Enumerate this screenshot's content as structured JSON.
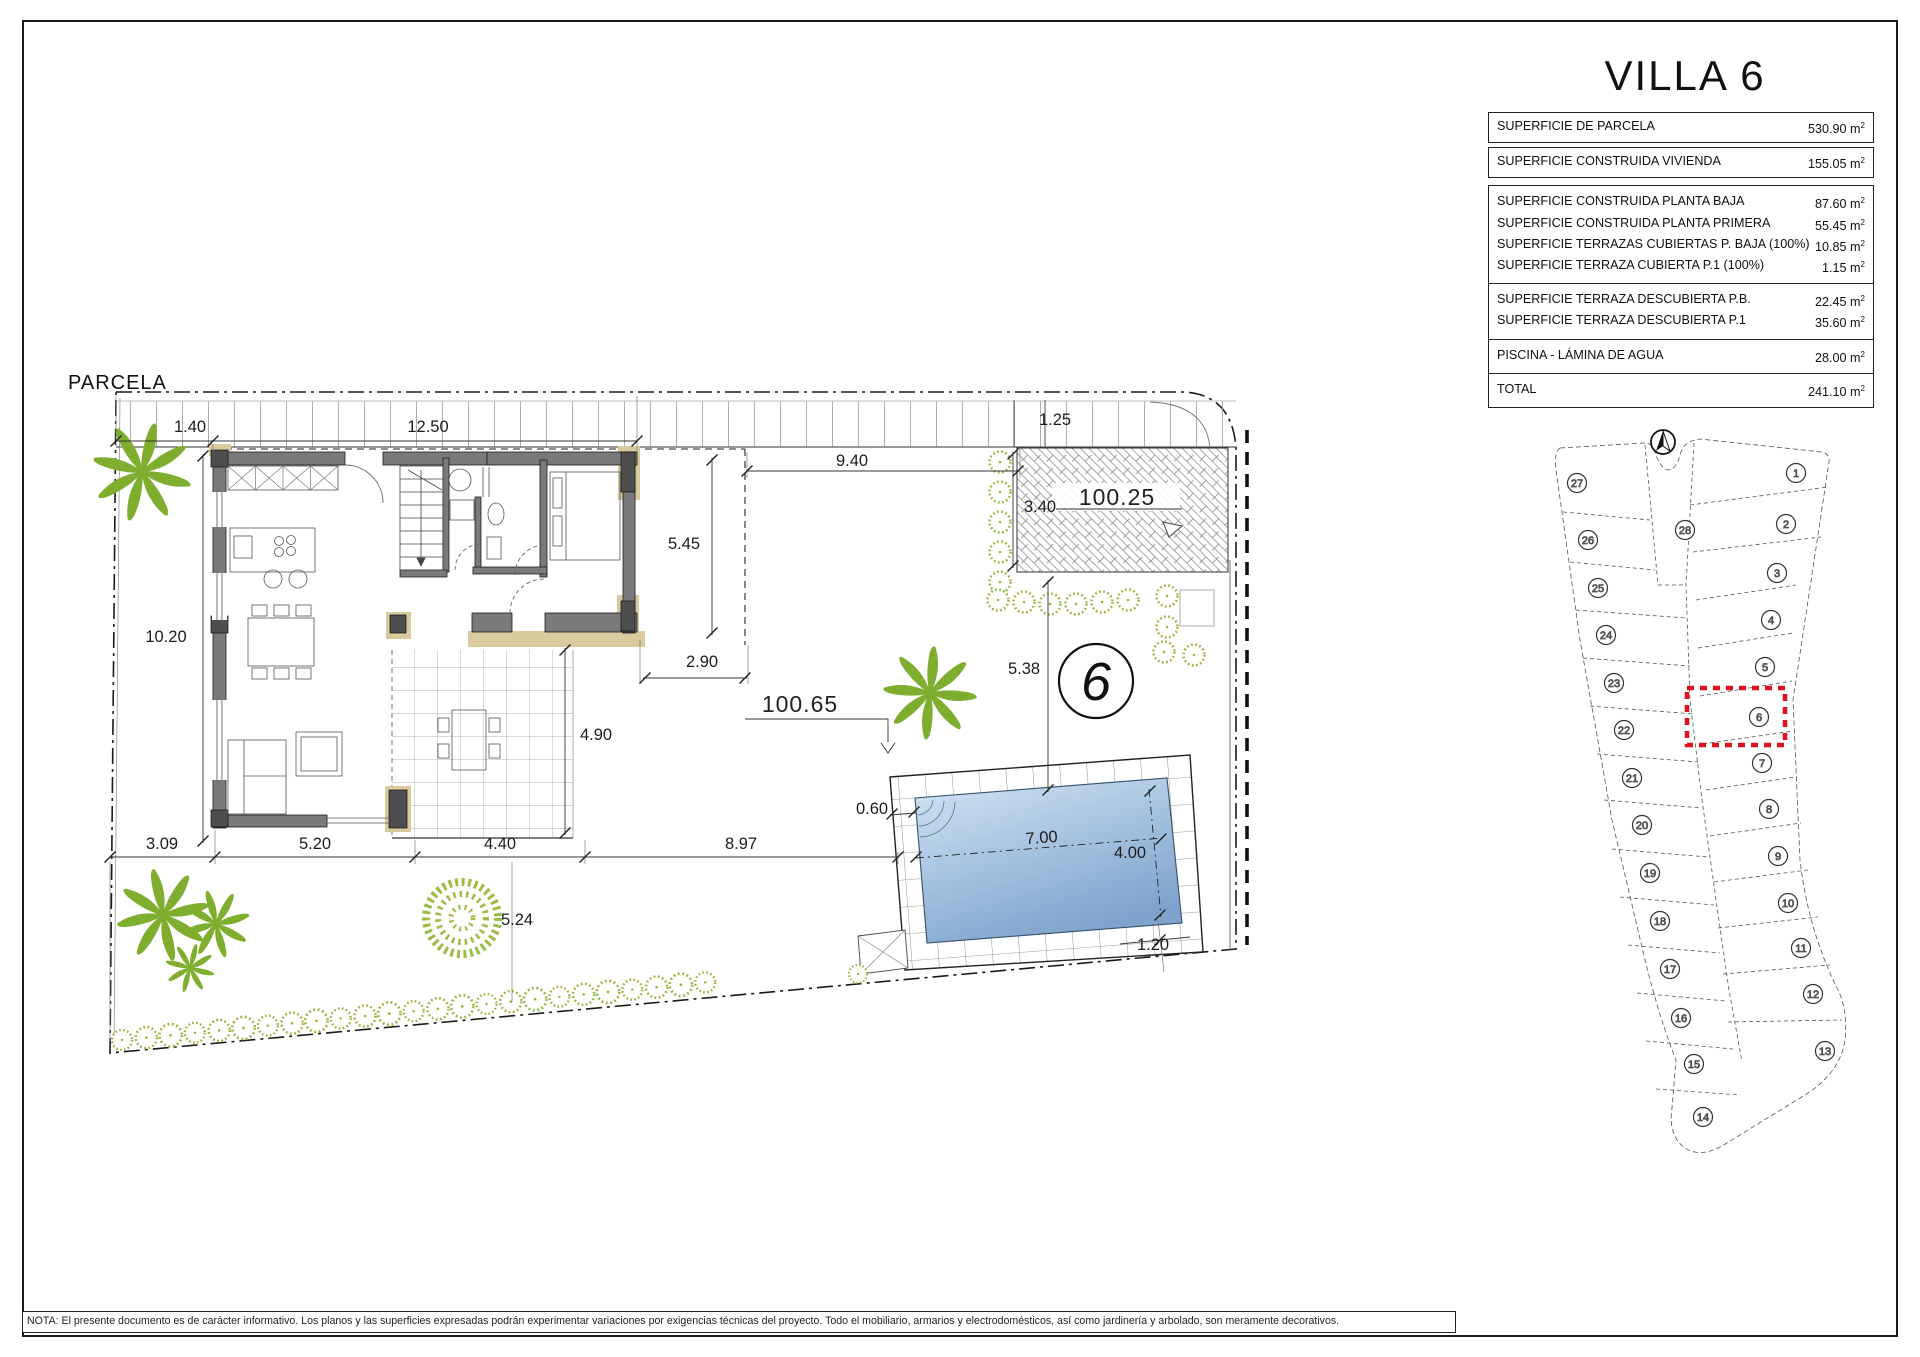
{
  "title": "VILLA 6",
  "unit": {
    "base": "m",
    "sup": "2"
  },
  "summary_table": {
    "top_rows": [
      {
        "label": "SUPERFICIE DE PARCELA",
        "value": "530.90"
      },
      {
        "label": "SUPERFICIE CONSTRUIDA VIVIENDA",
        "value": "155.05"
      }
    ],
    "groups": [
      [
        {
          "label": "SUPERFICIE CONSTRUIDA PLANTA BAJA",
          "value": "87.60"
        },
        {
          "label": "SUPERFICIE CONSTRUIDA PLANTA PRIMERA",
          "value": "55.45"
        },
        {
          "label": "SUPERFICIE TERRAZAS CUBIERTAS P. BAJA (100%)",
          "value": "10.85"
        },
        {
          "label": "SUPERFICIE TERRAZA CUBIERTA P.1 (100%)",
          "value": "1.15"
        }
      ],
      [
        {
          "label": "SUPERFICIE TERRAZA DESCUBIERTA P.B.",
          "value": "22.45"
        },
        {
          "label": "SUPERFICIE TERRAZA DESCUBIERTA P.1",
          "value": "35.60"
        }
      ],
      [
        {
          "label": "PISCINA - LÁMINA DE AGUA",
          "value": "28.00"
        }
      ],
      [
        {
          "label": "TOTAL",
          "value": "241.10"
        }
      ]
    ]
  },
  "plan": {
    "parcela_label": "PARCELA",
    "villa_number": "6",
    "areas": {
      "driveway": "100.25",
      "garden": "100.65"
    },
    "dimensions": {
      "d140": "1.40",
      "d1250": "12.50",
      "d125": "1.25",
      "d940": "9.40",
      "d340": "3.40",
      "d545": "5.45",
      "d1020": "10.20",
      "d290": "2.90",
      "d538": "5.38",
      "d490": "4.90",
      "d060": "0.60",
      "d309": "3.09",
      "d520": "5.20",
      "d440": "4.40",
      "d897": "8.97",
      "d700": "7.00",
      "d400": "4.00",
      "d524": "5.24",
      "d120": "1.20"
    }
  },
  "site_plan": {
    "highlighted_plot": "6",
    "plots": [
      {
        "n": "27",
        "x": 1577,
        "y": 483
      },
      {
        "n": "26",
        "x": 1588,
        "y": 540
      },
      {
        "n": "25",
        "x": 1598,
        "y": 588
      },
      {
        "n": "24",
        "x": 1606,
        "y": 635
      },
      {
        "n": "23",
        "x": 1614,
        "y": 683
      },
      {
        "n": "22",
        "x": 1624,
        "y": 730
      },
      {
        "n": "21",
        "x": 1632,
        "y": 778
      },
      {
        "n": "20",
        "x": 1642,
        "y": 825
      },
      {
        "n": "19",
        "x": 1650,
        "y": 873
      },
      {
        "n": "18",
        "x": 1660,
        "y": 921
      },
      {
        "n": "17",
        "x": 1670,
        "y": 969
      },
      {
        "n": "16",
        "x": 1681,
        "y": 1018
      },
      {
        "n": "15",
        "x": 1694,
        "y": 1064
      },
      {
        "n": "14",
        "x": 1703,
        "y": 1117
      },
      {
        "n": "28",
        "x": 1685,
        "y": 530
      },
      {
        "n": "1",
        "x": 1796,
        "y": 473
      },
      {
        "n": "2",
        "x": 1786,
        "y": 524
      },
      {
        "n": "3",
        "x": 1777,
        "y": 573
      },
      {
        "n": "4",
        "x": 1771,
        "y": 620
      },
      {
        "n": "5",
        "x": 1765,
        "y": 667
      },
      {
        "n": "6",
        "x": 1759,
        "y": 717
      },
      {
        "n": "7",
        "x": 1762,
        "y": 763
      },
      {
        "n": "8",
        "x": 1769,
        "y": 809
      },
      {
        "n": "9",
        "x": 1778,
        "y": 856
      },
      {
        "n": "10",
        "x": 1788,
        "y": 903
      },
      {
        "n": "11",
        "x": 1801,
        "y": 948
      },
      {
        "n": "12",
        "x": 1813,
        "y": 994
      },
      {
        "n": "13",
        "x": 1825,
        "y": 1051
      }
    ]
  },
  "note": "NOTA: El presente documento es de carácter informativo. Los planos y las superficies expresadas podrán experimentar variaciones por exigencias técnicas del proyecto. Todo el mobiliario, armarios y electrodomésticos, así como jardinería y arbolado, son meramente decorativos."
}
